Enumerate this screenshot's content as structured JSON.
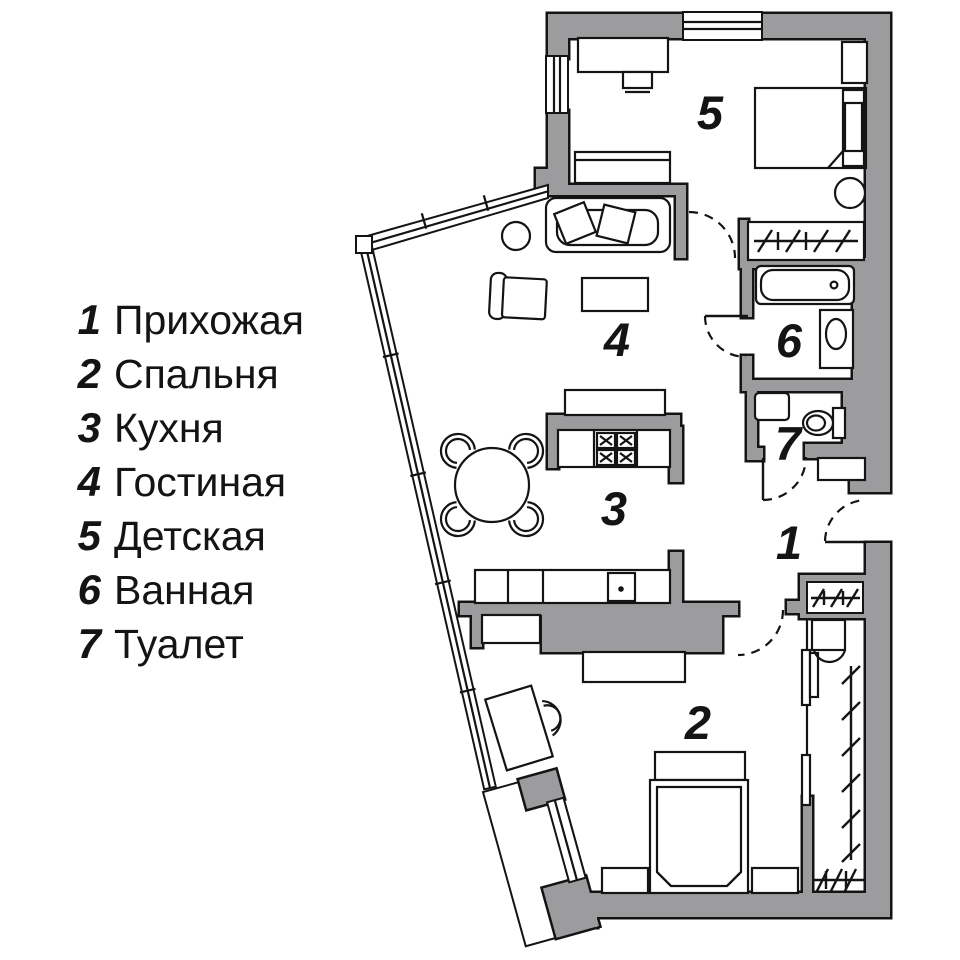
{
  "title": "Apartment floor plan with room legend",
  "colors": {
    "wall_fill": "#9c9c9e",
    "line": "#141414",
    "background": "#ffffff"
  },
  "rooms": [
    {
      "num": "1",
      "name": "Прихожая"
    },
    {
      "num": "2",
      "name": "Спальня"
    },
    {
      "num": "3",
      "name": "Кухня"
    },
    {
      "num": "4",
      "name": "Гостиная"
    },
    {
      "num": "5",
      "name": "Детская"
    },
    {
      "num": "6",
      "name": "Ванная"
    },
    {
      "num": "7",
      "name": "Туалет"
    }
  ],
  "furniture_icons": [
    "desk-icon",
    "chair-icon",
    "bed-icon",
    "nightstand-icon",
    "pouf-icon",
    "couch-icon",
    "wardrobe-rail-icon",
    "bathtub-icon",
    "sink-icon",
    "washing-machine-icon",
    "toilet-icon",
    "sofa-icon",
    "pillow-icon",
    "side-table-icon",
    "armchair-icon",
    "coffee-table-icon",
    "tv-console-icon",
    "stove-icon",
    "kitchen-counter-icon",
    "kitchen-sink-icon",
    "dining-table-icon",
    "dining-chair-icon",
    "double-bed-icon",
    "dresser-icon",
    "dressing-table-icon",
    "shelf-icon",
    "sliding-door-icon",
    "window-icon",
    "door-arc-icon",
    "balcony-icon"
  ]
}
